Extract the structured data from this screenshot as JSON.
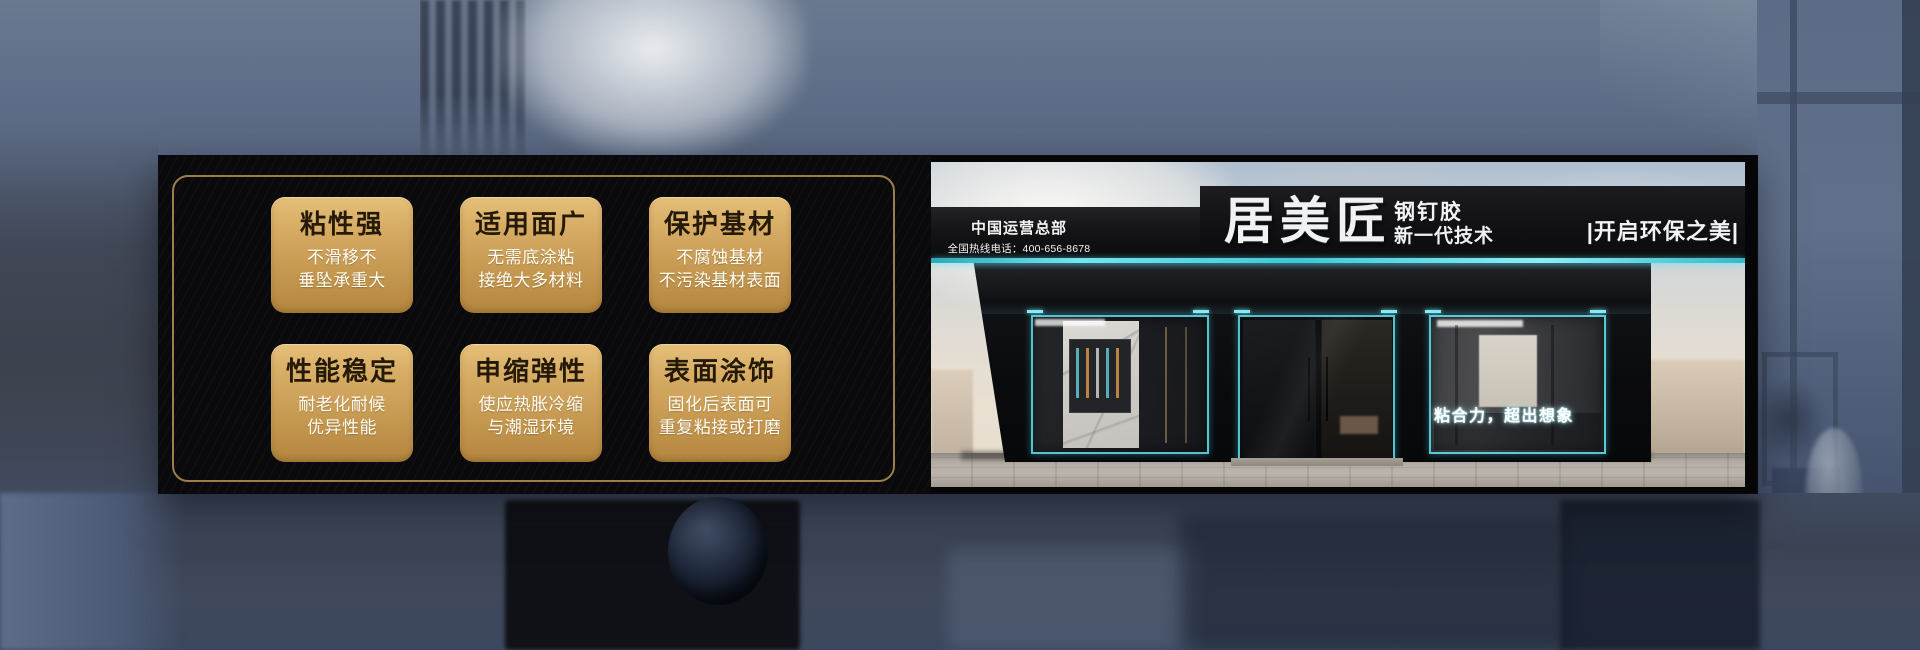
{
  "banner": {
    "features": [
      {
        "title": "粘性强",
        "line1": "不滑移不",
        "line2": "垂坠承重大"
      },
      {
        "title": "适用面广",
        "line1": "无需底涂粘",
        "line2": "接绝大多材料"
      },
      {
        "title": "保护基材",
        "line1": "不腐蚀基材",
        "line2": "不污染基材表面"
      },
      {
        "title": "性能稳定",
        "line1": "耐老化耐候",
        "line2": "优异性能"
      },
      {
        "title": "申缩弹性",
        "line1": "使应热胀冷缩",
        "line2": "与潮湿环境"
      },
      {
        "title": "表面涂饰",
        "line1": "固化后表面可",
        "line2": "重复粘接或打磨"
      }
    ],
    "storefront": {
      "hq_label": "中国运营总部",
      "hotline": "全国热线电话：400-656-8678",
      "brand": "居美匠",
      "product": "钢钉胶",
      "tagline": "新一代技术",
      "right_slogan": "|开启环保之美|",
      "window_slogan": "粘合力，超出想象"
    },
    "colors": {
      "card_gold_top": "#e5bf79",
      "card_gold_bottom": "#b48640",
      "card_title": "#241a07",
      "card_text": "#ffffff",
      "frame_gold": "#a9894e",
      "panel_black": "#0a0a0c",
      "led_teal": "#4fd8e6",
      "sign_black": "#121216",
      "sign_text": "#f2f2f2",
      "background_slate": "#5f6e88"
    }
  }
}
